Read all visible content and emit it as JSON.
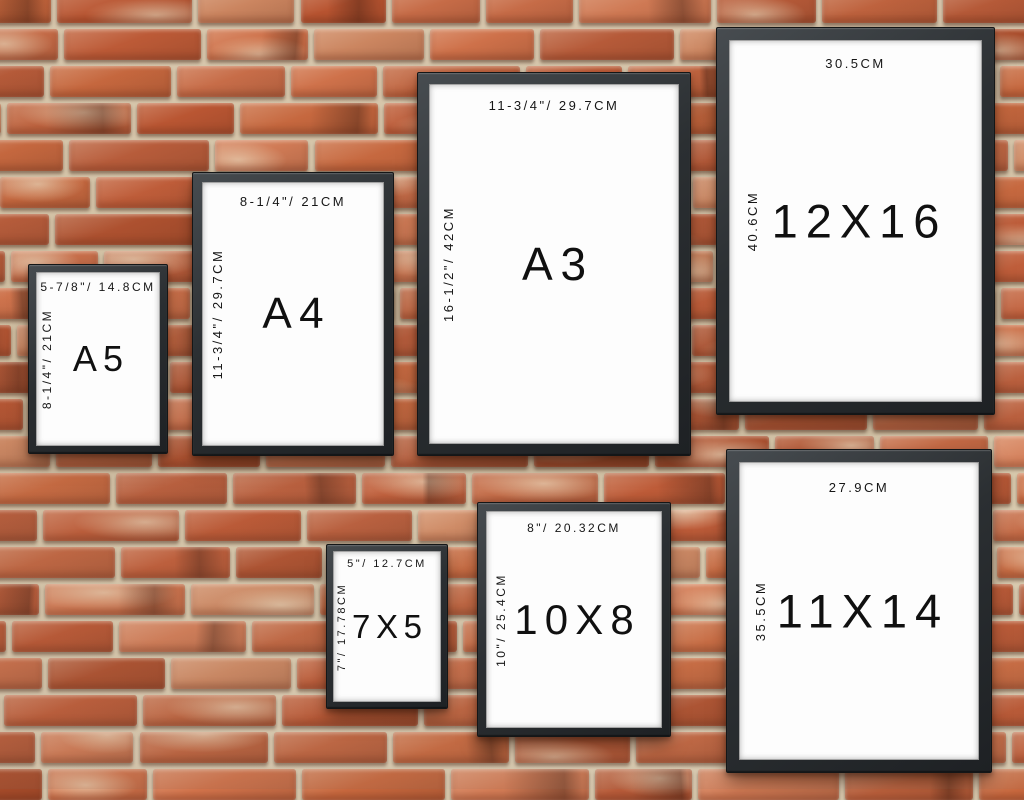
{
  "scene": {
    "description": "red brick wall with hanging black picture frames showing print sizes",
    "mortar_color": "#d8c9ad",
    "brick_palette": [
      "#c05c38",
      "#cb6f4a",
      "#c26540",
      "#d47d57",
      "#bc5632",
      "#d08a64",
      "#b95c3a",
      "#d3744c",
      "#c9693f",
      "#ae4f2d"
    ],
    "brick_light_patch_color": "#eee0c4",
    "frame_color": "#2b2f32",
    "paper_color": "#fdfdfd",
    "text_color": "#161616"
  },
  "frames": [
    {
      "id": "a5",
      "label": "A5",
      "width_label": "5-7/8\"/ 14.8CM",
      "height_label": "8-1/4\"/ 21CM"
    },
    {
      "id": "a4",
      "label": "A4",
      "width_label": "8-1/4\"/ 21CM",
      "height_label": "11-3/4\"/ 29.7CM"
    },
    {
      "id": "a3",
      "label": "A3",
      "width_label": "11-3/4\"/ 29.7CM",
      "height_label": "16-1/2\"/ 42CM"
    },
    {
      "id": "12x16",
      "label": "12X16",
      "width_label": "30.5CM",
      "height_label": "40.6CM"
    },
    {
      "id": "7x5",
      "label": "7X5",
      "width_label": "5\"/ 12.7CM",
      "height_label": "7\"/ 17.78CM"
    },
    {
      "id": "10x8",
      "label": "10X8",
      "width_label": "8\"/ 20.32CM",
      "height_label": "10\"/ 25.4CM"
    },
    {
      "id": "11x14",
      "label": "11X14",
      "width_label": "27.9CM",
      "height_label": "35.5CM"
    }
  ]
}
